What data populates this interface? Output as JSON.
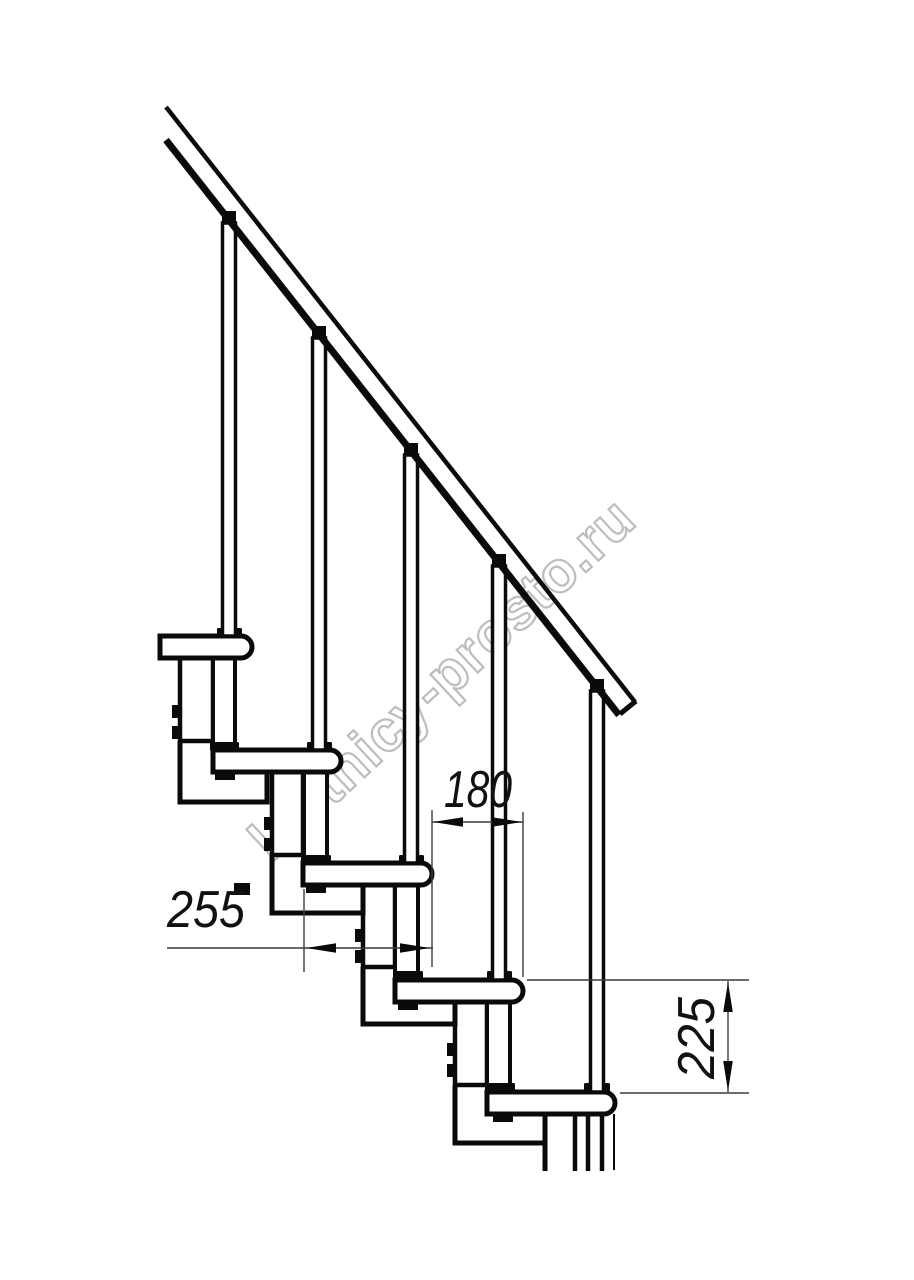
{
  "drawing": {
    "type": "modular-staircase-side-view",
    "dimensions": {
      "run": {
        "label": "180"
      },
      "tread_depth": {
        "label": "255"
      },
      "rise": {
        "label": "225"
      }
    },
    "counts": {
      "treads": 5,
      "balusters": 5,
      "handrails": 1
    }
  },
  "watermark": {
    "text": "lestnicy-prosto.ru"
  },
  "colors": {
    "background": "#ffffff",
    "line": "#0a0a0a",
    "dim_line": "#3c3c3c",
    "dim_text": "#111111",
    "watermark": "#bdbdbd"
  }
}
